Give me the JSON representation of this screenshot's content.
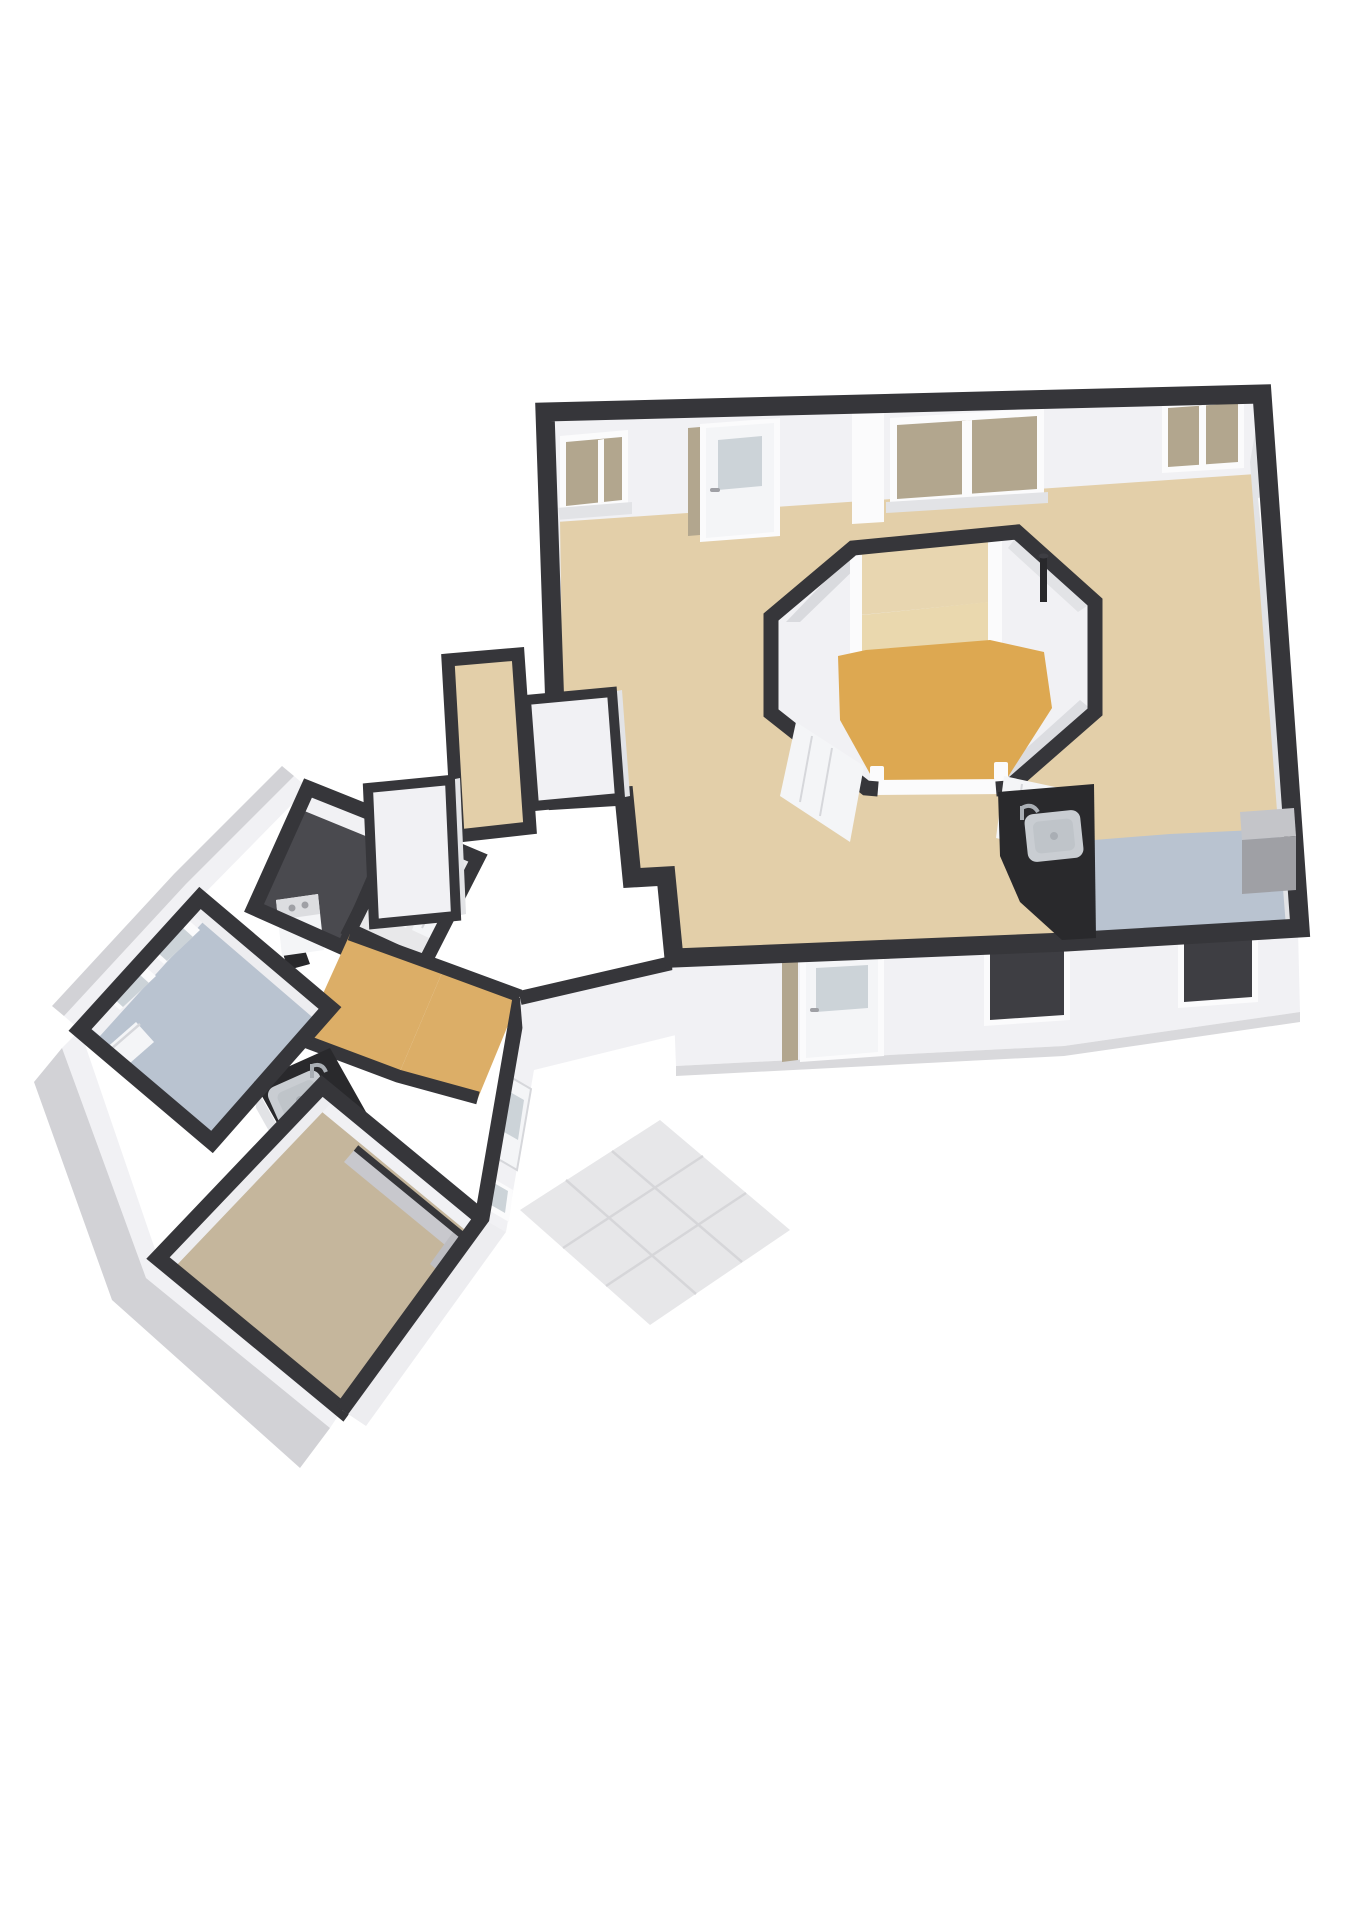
{
  "meta": {
    "title": "3D dollhouse floor plan render — two floor sections viewed isometrically",
    "image_type": "architectural 3D floor plan",
    "background": "#ffffff"
  },
  "palette": {
    "wall_cap": "#36363a",
    "wall_face": "#f1f1f4",
    "wall_face_dim": "#ededf0",
    "wall_shade": "#e2e3e6",
    "inner_shade": "#d9dade",
    "inner_shade2": "#dcdde1",
    "floor_tan": "#e3cfa9",
    "floor_orange": "#dda851",
    "room_wall_tan": "#e8d6b0",
    "room_floor_tan": "#ead8ae",
    "floor_blue": "#b9c3d0",
    "floor_taupe": "#c5b69c",
    "floor_hall": "#dcae67",
    "floor_dark": "#4a4a4f",
    "closet_floor": "#e8e8ea",
    "counter_dark": "#29292c",
    "steel": "#c9cdd2",
    "steel_deep": "#a9aeb4",
    "steel_inner": "#bfc4c9",
    "glass": "#ccd3d8",
    "backing_tan": "#b2a68e",
    "door_white": "#f4f5f7",
    "trim_white": "#fbfbfc",
    "door_line": "#d6d7db",
    "partition_gray": "#c8c8cd",
    "partition_gray2": "#bdbdc2",
    "cabinet_gray": "#9fa0a5",
    "cabinet_top": "#c4c5c9",
    "patio": "#e7e7e9",
    "patio_line": "#d6d6d9",
    "apron": "#d2d2d6",
    "washer_panel": "#dcdde0",
    "dark_detail": "#28282b",
    "win_dark": "#3e3e43",
    "base_strip": "#d9d9dc"
  },
  "scene": {
    "upper_floor": {
      "rooms": [
        {
          "name": "large open room",
          "floor": "floor_tan"
        },
        {
          "name": "central core room",
          "floor": "floor_orange"
        },
        {
          "name": "inner cabin room",
          "floor": "room_floor_tan"
        },
        {
          "name": "kitchenette corner",
          "floor": "floor_blue"
        }
      ],
      "fixtures": [
        "window",
        "glazed entry door",
        "open door leaves",
        "dark kitchen counter",
        "stainless sink with faucet",
        "gray cabinet",
        "vent pipe",
        "exterior door",
        "two dark windows"
      ]
    },
    "lower_floor": {
      "rooms": [
        {
          "name": "bathroom / kitchen room",
          "floor": "floor_blue"
        },
        {
          "name": "utility room with washer",
          "floor": "floor_dark"
        },
        {
          "name": "closet with double doors",
          "floor": "closet_floor"
        },
        {
          "name": "hallway",
          "floor": "floor_hall"
        },
        {
          "name": "bedroom with gray partition",
          "floor": "floor_taupe"
        }
      ],
      "fixtures": [
        "washing machine",
        "dark counter with stainless sink",
        "two windows",
        "interior doors",
        "glazed exterior door",
        "small window",
        "tiled patio",
        "concrete apron"
      ]
    },
    "connector": {
      "rooms": [
        {
          "name": "entry vestibule",
          "floor": "floor_tan"
        }
      ],
      "fixtures": [
        "two white storage closets"
      ]
    }
  }
}
